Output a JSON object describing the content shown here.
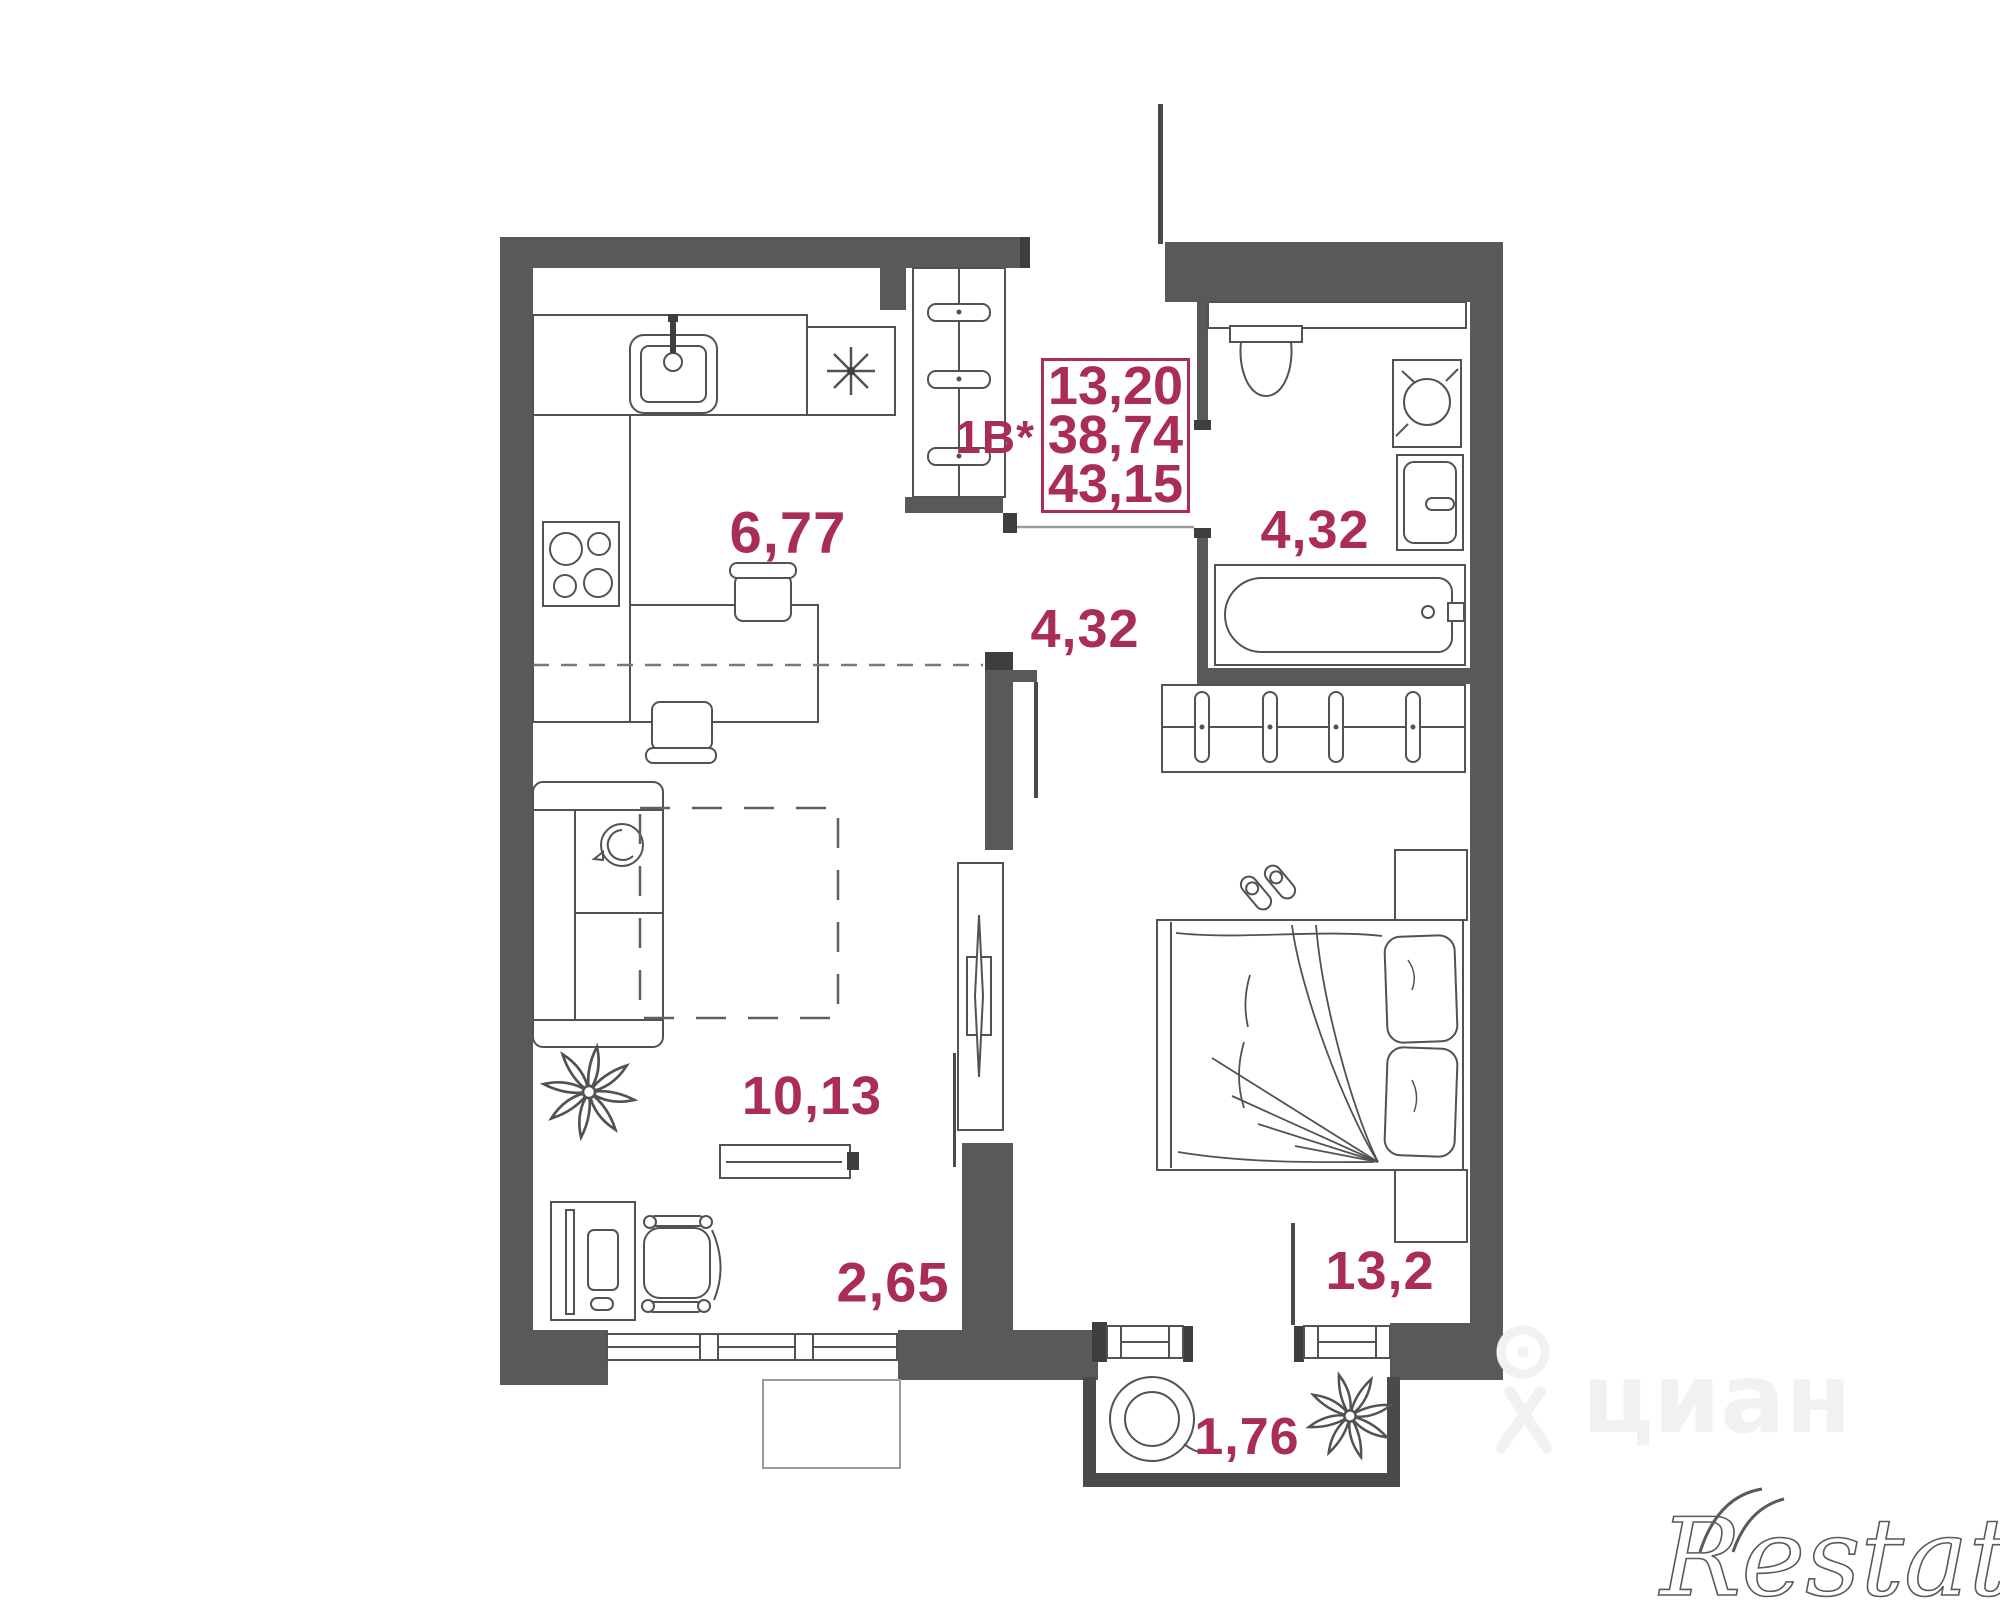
{
  "plan": {
    "unit_label": "1B*",
    "spec_values": [
      "13,20",
      "38,74",
      "43,15"
    ],
    "rooms": {
      "kitchen": "6,77",
      "hallway": "4,32",
      "bathroom": "4,32",
      "living": "10,13",
      "corridor": "2,65",
      "bedroom": "13,2",
      "balcony": "1,76"
    },
    "colors": {
      "wall": "#59595b",
      "accent": "#a92d57",
      "line": "#515256"
    }
  },
  "watermarks": {
    "portal": "циан",
    "agency": "Restate"
  }
}
